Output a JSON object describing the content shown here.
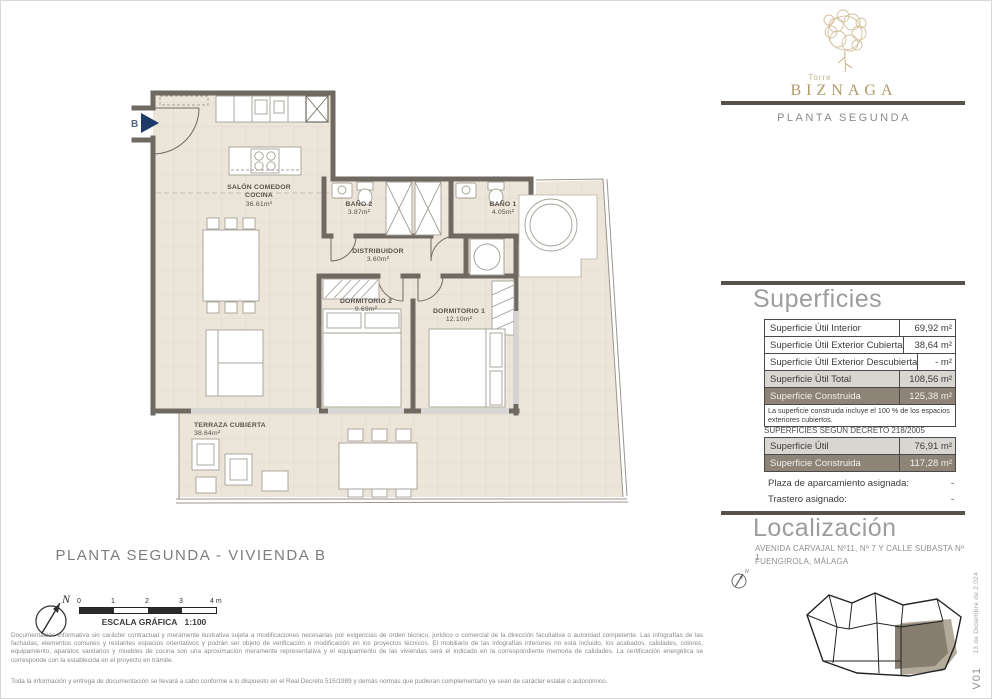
{
  "sidebar": {
    "logo": {
      "top": "Torre",
      "brand": "BIZNAGA"
    },
    "floor_label": "PLANTA SEGUNDA",
    "superficies": {
      "title": "Superficies",
      "rows": [
        {
          "label": "Superficie Útil Interior",
          "value": "69,92 m²"
        },
        {
          "label": "Superficie Útil Exterior Cubierta",
          "value": "38,64 m²"
        },
        {
          "label": "Superficie Útil Exterior Descubierta",
          "value": "- m²"
        },
        {
          "label": "Superficie Útil Total",
          "value": "108,56 m²"
        },
        {
          "label": "Superficie Construida",
          "value": "125,38 m²"
        }
      ],
      "note": "La superficie construida incluye el 100 % de los espacios exteriores cubiertos."
    },
    "decreto": {
      "title": "SUPERFICIES SEGUN DECRETO 218/2005",
      "rows": [
        {
          "label": "Superficie Útil",
          "value": "76,91 m²"
        },
        {
          "label": "Superficie Construida",
          "value": "117,28 m²"
        }
      ],
      "extras": [
        {
          "label": "Plaza de aparcamiento asignada:",
          "value": "-"
        },
        {
          "label": "Trastero asignado:",
          "value": "-"
        }
      ]
    },
    "localizacion": {
      "title": "Localización",
      "address1": "AVENIDA CARVAJAL Nº11, Nº 7 Y CALLE SUBASTA Nº 1",
      "address2": "FUENGIROLA, MÁLAGA",
      "compass": "N"
    },
    "version": {
      "code": "V01",
      "date": "13 de Diciembre de 2.024"
    }
  },
  "plan": {
    "entry": "B",
    "rooms": {
      "salon": {
        "line1": "SALÓN COMEDOR",
        "line2": "COCINA",
        "area": "36.61m²"
      },
      "bano2": {
        "name": "BAÑO 2",
        "area": "3.87m²"
      },
      "bano1": {
        "name": "BAÑO 1",
        "area": "4.05m²"
      },
      "distribuidor": {
        "name": "DISTRIBUIDOR",
        "area": "3.60m²"
      },
      "dormitorio2": {
        "name": "DORMITORIO 2",
        "area": "9.69m²"
      },
      "dormitorio1": {
        "name": "DORMITORIO 1",
        "area": "12.10m²"
      },
      "terraza": {
        "name": "TERRAZA CUBIERTA",
        "area": "38.64m²"
      }
    }
  },
  "footer": {
    "title": "PLANTA SEGUNDA - VIVIENDA B",
    "compass": "N",
    "scale": {
      "ticks": [
        "0",
        "1",
        "2",
        "3",
        "4 m"
      ],
      "label": "ESCALA GRÁFICA",
      "ratio": "1:100"
    },
    "disclaimer1": "Documentación informativa sin carácter contractual y meramente ilustrativa sujeta a modificaciones necesarias por exigencias de orden técnico, jurídico o comercial de la dirección facultativa o autoridad competente. Las infografías de las fachadas, elementos comunes y restantes espacios orientativos y podrán ser objeto de verificación o modificación en los proyectos técnicos. El mobiliario de las infografías interiores no está incluido, los acabados, calidades, colores, equipamiento, aparatos sanitarios y muebles de cocina son una aproximación meramente representativa y el equipamiento de las viviendas será el indicado en la correspondiente memoria de calidades. La certificación energética se corresponde con la establecida en el proyecto en trámite.",
    "disclaimer2": "Toda la información y entrega de documentación se llevará a cabo conforme a lo dispuesto en el Real Decreto 515/1989 y demás normas que pudieran complementarlo ya sean de carácter estatal o autonómico."
  }
}
